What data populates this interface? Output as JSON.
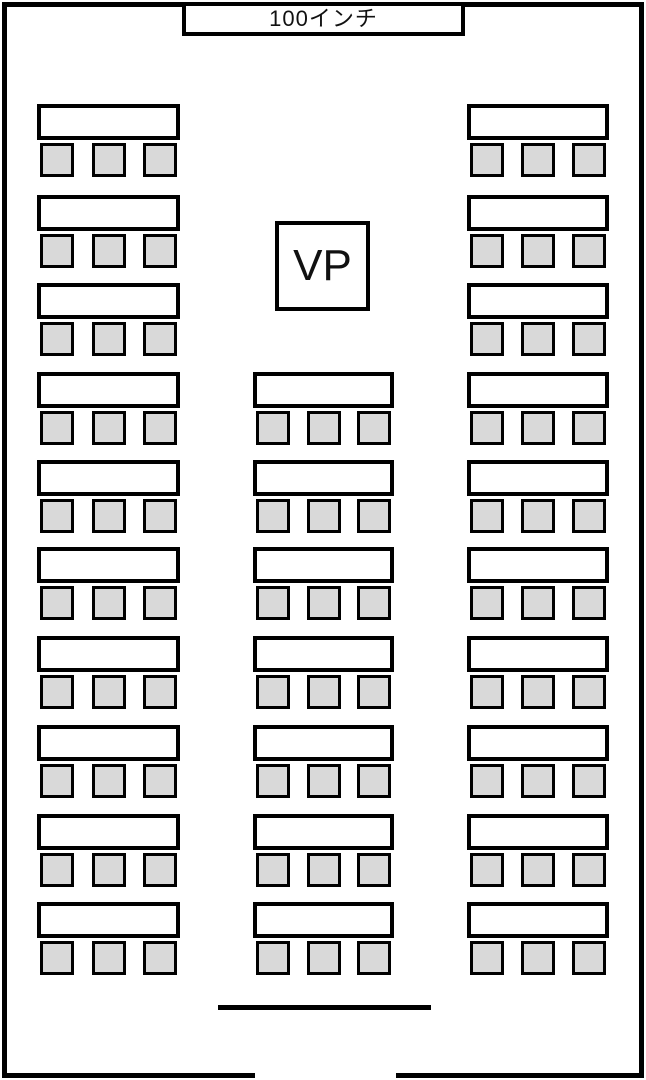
{
  "screen": {
    "label": "100インチ"
  },
  "projector": {
    "label": "VP"
  },
  "layout": {
    "chairs_per_table": 3,
    "columns": [
      {
        "name": "left",
        "table_count": 10,
        "first_row": 0
      },
      {
        "name": "center",
        "table_count": 7,
        "first_row": 3
      },
      {
        "name": "right",
        "table_count": 10,
        "first_row": 0
      }
    ],
    "total_tables": 27,
    "total_seats": 81
  },
  "entrance": {
    "location": "bottom-center"
  },
  "colors": {
    "wall": "#000000",
    "table_fill": "#ffffff",
    "chair_fill": "#d9d9d9",
    "chair_border": "#000000"
  }
}
